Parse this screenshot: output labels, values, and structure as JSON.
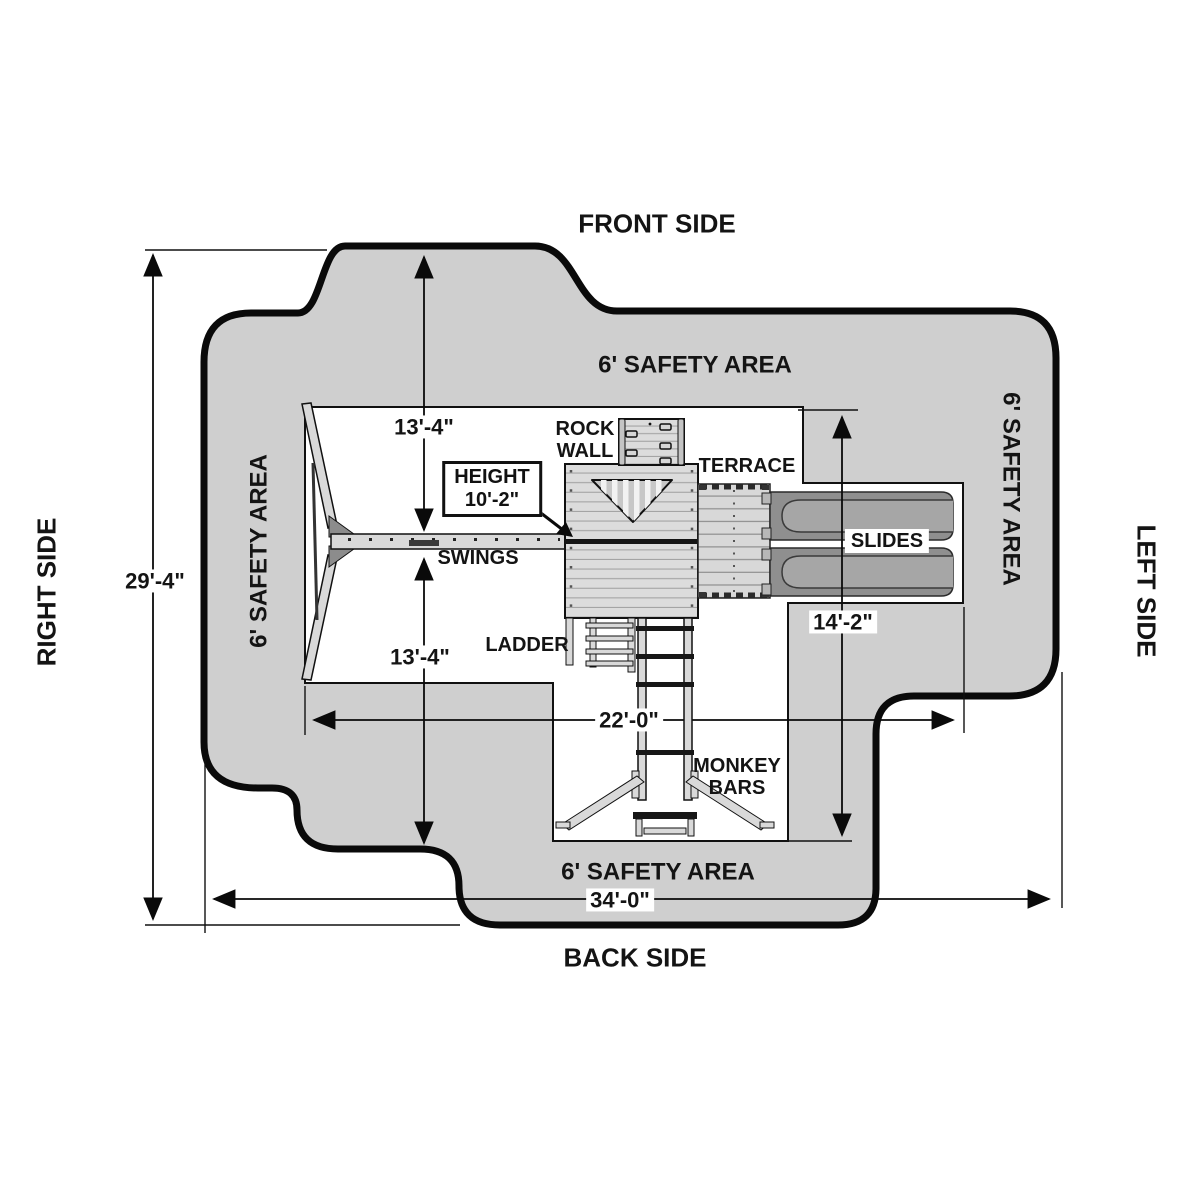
{
  "diagram": {
    "sides": {
      "front": "FRONT SIDE",
      "back": "BACK SIDE",
      "left": "LEFT SIDE",
      "right": "RIGHT SIDE"
    },
    "safety_area_label": "6' SAFETY AREA",
    "dimensions": {
      "overall_depth": "29'-4\"",
      "front_to_swing_beam": "13'-4\"",
      "swing_beam_to_back": "13'-4\"",
      "play_area_width": "22'-0\"",
      "overall_width": "34'-0\"",
      "slide_side_depth": "14'-2\"",
      "height_title": "HEIGHT",
      "height_value": "10'-2\""
    },
    "components": {
      "rock_wall_line1": "ROCK",
      "rock_wall_line2": "WALL",
      "terrace": "TERRACE",
      "slides": "SLIDES",
      "swings": "SWINGS",
      "ladder": "LADDER",
      "monkey_bars_line1": "MONKEY",
      "monkey_bars_line2": "BARS"
    },
    "colors": {
      "safety_area_fill": "#cfcfcf",
      "outline": "#0a0a0a",
      "structure_fill": "#dcdcdc",
      "slide_fill": "#8f8f8f"
    }
  }
}
